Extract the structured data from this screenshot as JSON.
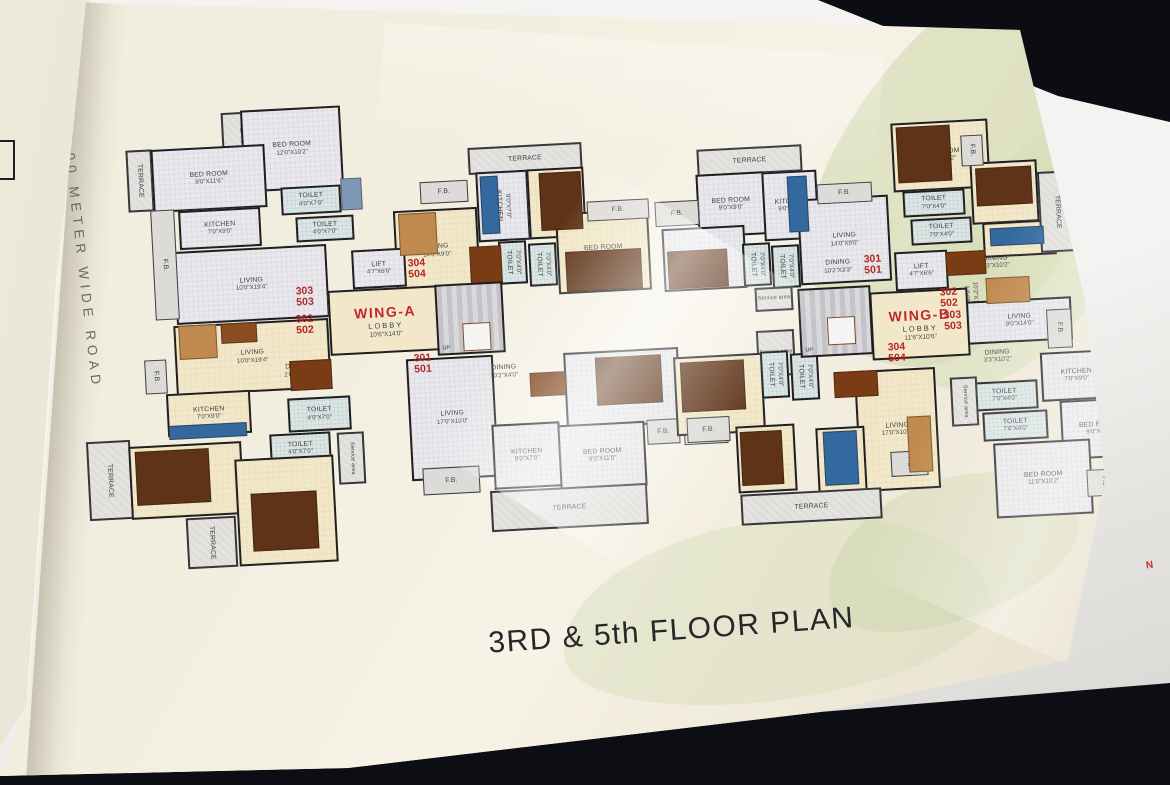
{
  "scene": {
    "title": "3RD & 5th FLOOR PLAN",
    "road_label": "24.00 METER WIDE ROAD",
    "north_marker": "N",
    "colors": {
      "background": "#0d0e14",
      "page": "#f2eedf",
      "wall": "#1f1f22",
      "unit_number": "#b42525",
      "wing_label": "#c02828",
      "room_cream": "#f2e8c9",
      "room_gray": "#e9e9ed",
      "terrace": "#e3e2de",
      "toilet": "#dce6e4",
      "furniture_wood": "#5f3317",
      "kitchen_counter": "#33699e"
    }
  },
  "plan": {
    "cores": [
      {
        "wing": "WING-A",
        "lobby": "LOBBY",
        "dims": "10'6\"X14'0\"",
        "x": 329,
        "y": 288,
        "w": 113,
        "h": 65,
        "stair": {
          "x": 436,
          "y": 283,
          "w": 68,
          "h": 71,
          "lx": 24,
          "ly": 38,
          "lw": 26,
          "lh": 26
        },
        "up": "UP"
      },
      {
        "wing": "WING-B",
        "lobby": "LOBBY",
        "dims": "11'6\"X10'6\"",
        "x": 871,
        "y": 290,
        "w": 98,
        "h": 68,
        "stair": {
          "x": 799,
          "y": 287,
          "w": 73,
          "h": 69,
          "lx": 26,
          "ly": 28,
          "lw": 26,
          "lh": 26
        },
        "up": "UP"
      }
    ],
    "units": [
      {
        "a": "303",
        "b": "503",
        "x": 296,
        "y": 286
      },
      {
        "a": "302",
        "b": "502",
        "x": 296,
        "y": 314
      },
      {
        "a": "304",
        "b": "504",
        "x": 408,
        "y": 258
      },
      {
        "a": "301",
        "b": "501",
        "x": 414,
        "y": 353
      },
      {
        "a": "301",
        "b": "501",
        "x": 864,
        "y": 254
      },
      {
        "a": "302",
        "b": "502",
        "x": 940,
        "y": 287
      },
      {
        "a": "303",
        "b": "503",
        "x": 944,
        "y": 310
      },
      {
        "a": "304",
        "b": "504",
        "x": 888,
        "y": 342
      }
    ],
    "rooms": [
      {
        "label": "TERRACE",
        "x": 222,
        "y": 112,
        "w": 40,
        "h": 56,
        "f": "terrace",
        "v": 1
      },
      {
        "label": "BED ROOM",
        "dims": "12'0\"X10'2\"",
        "x": 242,
        "y": 108,
        "w": 100,
        "h": 82,
        "f": "hatch"
      },
      {
        "label": "TERRACE",
        "x": 127,
        "y": 150,
        "w": 26,
        "h": 62,
        "f": "terrace",
        "v": 1
      },
      {
        "label": "BED ROOM",
        "dims": "9'0\"X11'6\"",
        "x": 152,
        "y": 147,
        "w": 114,
        "h": 63,
        "f": "hatch"
      },
      {
        "label": "TOILET",
        "dims": "4'0\"X7'0\"",
        "x": 281,
        "y": 186,
        "w": 60,
        "h": 28,
        "f": "toilet"
      },
      {
        "label": "TOILET",
        "dims": "4'0\"X7'0\"",
        "x": 296,
        "y": 216,
        "w": 58,
        "h": 25,
        "f": "toilet"
      },
      {
        "label": "KITCHEN",
        "dims": "7'0\"X9'0\"",
        "x": 179,
        "y": 209,
        "w": 82,
        "h": 39,
        "f": "hatch"
      },
      {
        "label": "DINING",
        "dims": "2'0\"X10'2\"",
        "x": 264,
        "y": 241,
        "w": 66,
        "h": 23,
        "f": "hatch",
        "open": 1
      },
      {
        "label": "LIVING",
        "dims": "10'0\"X19'4\"",
        "x": 175,
        "y": 248,
        "w": 153,
        "h": 73,
        "f": "hatch"
      },
      {
        "label": "F.B.",
        "x": 153,
        "y": 210,
        "w": 24,
        "h": 110,
        "f": "fb",
        "v": 1
      },
      {
        "label": "LIVING",
        "dims": "10'0\"X19'4\"",
        "x": 175,
        "y": 322,
        "w": 155,
        "h": 70,
        "f": "cream"
      },
      {
        "label": "DINING",
        "dims": "2'0\"X10'0\"",
        "x": 266,
        "y": 352,
        "w": 64,
        "h": 38,
        "f": "cream",
        "open": 1
      },
      {
        "label": "F.B.",
        "x": 145,
        "y": 360,
        "w": 22,
        "h": 34,
        "f": "fb",
        "v": 1
      },
      {
        "label": "KITCHEN",
        "dims": "7'0\"X9'0\"",
        "x": 167,
        "y": 392,
        "w": 84,
        "h": 43,
        "f": "cream"
      },
      {
        "label": "TOILET",
        "dims": "4'0\"X7'0\"",
        "x": 288,
        "y": 397,
        "w": 63,
        "h": 34,
        "f": "toilet"
      },
      {
        "label": "TOILET",
        "dims": "4'0\"X7'0\"",
        "x": 270,
        "y": 433,
        "w": 61,
        "h": 31,
        "f": "toilet"
      },
      {
        "label": "Service area",
        "x": 338,
        "y": 432,
        "w": 27,
        "h": 52,
        "f": "terrace",
        "v": 1,
        "small": 1
      },
      {
        "label": "TERRACE",
        "x": 88,
        "y": 441,
        "w": 44,
        "h": 79,
        "f": "terrace",
        "v": 1
      },
      {
        "label": "BED ROOM",
        "dims": "9'0\"X11'6\"",
        "x": 130,
        "y": 444,
        "w": 113,
        "h": 73,
        "f": "cream"
      },
      {
        "label": "TERRACE",
        "x": 187,
        "y": 517,
        "w": 50,
        "h": 51,
        "f": "terrace",
        "v": 1
      },
      {
        "label": "BED ROOM",
        "dims": "12'0\"X10'2\"",
        "x": 237,
        "y": 457,
        "w": 99,
        "h": 107,
        "f": "cream"
      },
      {
        "label": "TERRACE",
        "x": 468,
        "y": 145,
        "w": 114,
        "h": 27,
        "f": "terrace"
      },
      {
        "label": "KITCHEN",
        "dims": "9'0\"X7'0\"",
        "x": 477,
        "y": 171,
        "w": 52,
        "h": 70,
        "f": "hatch",
        "v": 1
      },
      {
        "label": "BED ROOM",
        "dims": "9'0\"X9'0\"",
        "x": 528,
        "y": 168,
        "w": 57,
        "h": 70,
        "f": "cream",
        "v": 1
      },
      {
        "label": "F.B.",
        "x": 420,
        "y": 181,
        "w": 48,
        "h": 22,
        "f": "fb"
      },
      {
        "label": "DINING",
        "dims": "12'7\"X3'3\"",
        "x": 447,
        "y": 207,
        "w": 32,
        "h": 85,
        "f": "cream",
        "v": 1,
        "open": 1
      },
      {
        "label": "LIVING",
        "dims": "14'0\"X9'0\"",
        "x": 395,
        "y": 209,
        "w": 84,
        "h": 84,
        "f": "cream"
      },
      {
        "label": "TOILET",
        "dims": "7'0\"X4'0\"",
        "x": 499,
        "y": 241,
        "w": 28,
        "h": 43,
        "f": "toilet",
        "v": 1
      },
      {
        "label": "TOILET",
        "dims": "7'0\"X4'0\"",
        "x": 529,
        "y": 243,
        "w": 28,
        "h": 43,
        "f": "toilet",
        "v": 1
      },
      {
        "label": "BED ROOM",
        "dims": "10'2\"X11'0\"",
        "x": 557,
        "y": 211,
        "w": 93,
        "h": 81,
        "f": "cream"
      },
      {
        "label": "F.B.",
        "x": 587,
        "y": 200,
        "w": 62,
        "h": 20,
        "f": "fb"
      },
      {
        "label": "LIFT",
        "dims": "4'7\"X6'6\"",
        "x": 352,
        "y": 249,
        "w": 54,
        "h": 39,
        "f": "hatch"
      },
      {
        "label": "LIVING",
        "dims": "17'0\"X10'0\"",
        "x": 409,
        "y": 357,
        "w": 87,
        "h": 122,
        "f": "hatch"
      },
      {
        "label": "DINING",
        "dims": "10'2\"X4'0\"",
        "x": 468,
        "y": 352,
        "w": 72,
        "h": 40,
        "f": "hatch",
        "open": 1
      },
      {
        "label": "BED ROOM",
        "dims": "10'2\"X12'0\"",
        "x": 565,
        "y": 350,
        "w": 115,
        "h": 76,
        "f": "hatch"
      },
      {
        "label": "KITCHEN",
        "dims": "9'0\"X7'0\"",
        "x": 493,
        "y": 423,
        "w": 68,
        "h": 65,
        "f": "hatch"
      },
      {
        "label": "BED ROOM",
        "dims": "9'0\"X11'0\"",
        "x": 559,
        "y": 423,
        "w": 87,
        "h": 65,
        "f": "hatch"
      },
      {
        "label": "TERRACE",
        "x": 491,
        "y": 487,
        "w": 157,
        "h": 41,
        "f": "terrace"
      },
      {
        "label": "F.B.",
        "x": 423,
        "y": 467,
        "w": 57,
        "h": 27,
        "f": "fb"
      },
      {
        "label": "F.B.",
        "x": 647,
        "y": 419,
        "w": 33,
        "h": 25,
        "f": "fb"
      },
      {
        "label": "F.B.",
        "x": 684,
        "y": 419,
        "w": 44,
        "h": 25,
        "f": "fb"
      },
      {
        "label": "TERRACE",
        "x": 697,
        "y": 147,
        "w": 105,
        "h": 27,
        "f": "terrace"
      },
      {
        "label": "BED ROOM",
        "dims": "9'0\"X9'0\"",
        "x": 697,
        "y": 173,
        "w": 68,
        "h": 63,
        "f": "hatch"
      },
      {
        "label": "KITCHEN",
        "dims": "9'0\"X7'0\"",
        "x": 763,
        "y": 171,
        "w": 55,
        "h": 69,
        "f": "hatch"
      },
      {
        "label": "F.B.",
        "x": 655,
        "y": 201,
        "w": 44,
        "h": 25,
        "f": "fb"
      },
      {
        "label": "BED ROOM",
        "dims": "10'2\"X11'0\"",
        "x": 663,
        "y": 227,
        "w": 83,
        "h": 63,
        "f": "hatch"
      },
      {
        "label": "TOILET",
        "dims": "7'0\"X4'0\"",
        "x": 743,
        "y": 243,
        "w": 28,
        "h": 43,
        "f": "toilet",
        "v": 1
      },
      {
        "label": "TOILET",
        "dims": "7'0\"X4'0\"",
        "x": 772,
        "y": 245,
        "w": 28,
        "h": 43,
        "f": "toilet",
        "v": 1
      },
      {
        "label": "LIVING",
        "dims": "14'0\"X9'0\"",
        "x": 799,
        "y": 197,
        "w": 91,
        "h": 86,
        "f": "hatch"
      },
      {
        "label": "DINING",
        "dims": "10'2\"X3'3\"",
        "x": 800,
        "y": 251,
        "w": 76,
        "h": 32,
        "f": "hatch",
        "open": 1
      },
      {
        "label": "F.B.",
        "x": 817,
        "y": 183,
        "w": 55,
        "h": 20,
        "f": "fb"
      },
      {
        "label": "Service area",
        "x": 755,
        "y": 287,
        "w": 38,
        "h": 24,
        "f": "terrace",
        "small": 1
      },
      {
        "label": "Service area",
        "x": 757,
        "y": 330,
        "w": 38,
        "h": 46,
        "f": "terrace",
        "small": 1
      },
      {
        "label": "LIFT",
        "dims": "4'7\"X6'6\"",
        "x": 895,
        "y": 251,
        "w": 53,
        "h": 39,
        "f": "hatch"
      },
      {
        "label": "BED ROOM",
        "dims": "11'6\"X10'2\"",
        "x": 892,
        "y": 121,
        "w": 97,
        "h": 69,
        "f": "cream"
      },
      {
        "label": "TOILET",
        "dims": "7'0\"X4'0\"",
        "x": 903,
        "y": 190,
        "w": 62,
        "h": 26,
        "f": "toilet"
      },
      {
        "label": "TOILET",
        "dims": "7'0\"X4'0\"",
        "x": 911,
        "y": 218,
        "w": 61,
        "h": 26,
        "f": "toilet"
      },
      {
        "label": "BED ROOM",
        "dims": "9'0\"X9'0\"",
        "x": 971,
        "y": 161,
        "w": 67,
        "h": 62,
        "f": "cream"
      },
      {
        "label": "KITCHEN",
        "dims": "7'0\"X9'0\"",
        "x": 983,
        "y": 221,
        "w": 73,
        "h": 35,
        "f": "cream"
      },
      {
        "label": "DINING",
        "dims": "3'3\"X10'2\"",
        "x": 957,
        "y": 247,
        "w": 77,
        "h": 31,
        "f": "cream",
        "open": 1
      },
      {
        "label": "LIVING",
        "dims": "10'2\"X14'0\"",
        "x": 944,
        "y": 257,
        "w": 53,
        "h": 81,
        "f": "cream",
        "v": 1,
        "open": 1
      },
      {
        "label": "TERRACE",
        "x": 1039,
        "y": 171,
        "w": 37,
        "h": 81,
        "f": "terrace",
        "v": 1
      },
      {
        "label": "F.B.",
        "x": 961,
        "y": 135,
        "w": 22,
        "h": 31,
        "f": "fb",
        "v": 1
      },
      {
        "label": "LIVING",
        "dims": "9'0\"X14'0\"",
        "x": 967,
        "y": 299,
        "w": 105,
        "h": 43,
        "f": "hatch"
      },
      {
        "label": "DINING",
        "dims": "3'3\"X10'2\"",
        "x": 961,
        "y": 339,
        "w": 73,
        "h": 35,
        "f": "hatch",
        "open": 1
      },
      {
        "label": "F.B.",
        "x": 1047,
        "y": 309,
        "w": 25,
        "h": 39,
        "f": "fb",
        "v": 1
      },
      {
        "label": "TOILET",
        "dims": "7'0\"X4'0\"",
        "x": 971,
        "y": 381,
        "w": 67,
        "h": 29,
        "f": "toilet"
      },
      {
        "label": "TOILET",
        "dims": "7'0\"X4'0\"",
        "x": 983,
        "y": 411,
        "w": 65,
        "h": 29,
        "f": "toilet"
      },
      {
        "label": "KITCHEN",
        "dims": "7'0\"X9'0\"",
        "x": 1041,
        "y": 351,
        "w": 71,
        "h": 49,
        "f": "hatch"
      },
      {
        "label": "BED ROOM",
        "dims": "9'0\"X9'0\"",
        "x": 1061,
        "y": 399,
        "w": 75,
        "h": 59,
        "f": "hatch"
      },
      {
        "label": "BED ROOM",
        "dims": "11'0\"X10'2\"",
        "x": 995,
        "y": 441,
        "w": 97,
        "h": 75,
        "f": "hatch"
      },
      {
        "label": "TERRACE",
        "x": 1115,
        "y": 357,
        "w": 39,
        "h": 87,
        "f": "terrace",
        "v": 1
      },
      {
        "label": "Service area",
        "x": 951,
        "y": 377,
        "w": 27,
        "h": 49,
        "f": "terrace",
        "v": 1,
        "small": 1
      },
      {
        "label": "F.B.",
        "x": 1087,
        "y": 469,
        "w": 35,
        "h": 27,
        "f": "fb",
        "v": 1
      },
      {
        "label": "BED ROOM",
        "dims": "10'2\"X12'0\"",
        "x": 675,
        "y": 355,
        "w": 89,
        "h": 79,
        "f": "cream"
      },
      {
        "label": "TOILET",
        "dims": "7'0\"X4'0\"",
        "x": 761,
        "y": 351,
        "w": 28,
        "h": 47,
        "f": "toilet",
        "v": 1
      },
      {
        "label": "TOILET",
        "dims": "7'0\"X4'0\"",
        "x": 791,
        "y": 353,
        "w": 28,
        "h": 47,
        "f": "toilet",
        "v": 1
      },
      {
        "label": "DINING",
        "dims": "10'2\"X4'0\"",
        "x": 825,
        "y": 367,
        "w": 63,
        "h": 35,
        "f": "cream",
        "open": 1
      },
      {
        "label": "LIVING",
        "dims": "17'0\"X10'0\"",
        "x": 857,
        "y": 369,
        "w": 81,
        "h": 121,
        "f": "cream"
      },
      {
        "label": "BED ROOM",
        "dims": "9'0\"X11'0\"",
        "x": 737,
        "y": 425,
        "w": 59,
        "h": 67,
        "f": "cream",
        "v": 1
      },
      {
        "label": "KITCHEN",
        "dims": "9'0\"X7'0\"",
        "x": 817,
        "y": 427,
        "w": 49,
        "h": 67,
        "f": "cream",
        "v": 1
      },
      {
        "label": "TERRACE",
        "x": 741,
        "y": 491,
        "w": 141,
        "h": 31,
        "f": "terrace"
      },
      {
        "label": "F.B.",
        "x": 687,
        "y": 417,
        "w": 43,
        "h": 25,
        "f": "fb"
      },
      {
        "label": "F.B.",
        "x": 891,
        "y": 451,
        "w": 37,
        "h": 25,
        "f": "fb",
        "v": 1
      }
    ],
    "furniture": [
      {
        "x": 341,
        "y": 178,
        "w": 21,
        "h": 32,
        "c": "#7d98b5"
      },
      {
        "x": 179,
        "y": 325,
        "w": 38,
        "h": 34,
        "c": "#c08a4e"
      },
      {
        "x": 221,
        "y": 323,
        "w": 36,
        "h": 20,
        "c": "#8a4d22"
      },
      {
        "x": 290,
        "y": 360,
        "w": 42,
        "h": 30,
        "c": "#7a3c14"
      },
      {
        "x": 169,
        "y": 424,
        "w": 78,
        "h": 14,
        "c": "#33699e"
      },
      {
        "x": 136,
        "y": 450,
        "w": 74,
        "h": 54,
        "c": "#5f3317"
      },
      {
        "x": 252,
        "y": 492,
        "w": 66,
        "h": 58,
        "c": "#5f3317"
      },
      {
        "x": 399,
        "y": 213,
        "w": 38,
        "h": 42,
        "c": "#c08a4e"
      },
      {
        "x": 481,
        "y": 176,
        "w": 18,
        "h": 58,
        "c": "#33699e"
      },
      {
        "x": 540,
        "y": 172,
        "w": 42,
        "h": 58,
        "c": "#5f3317"
      },
      {
        "x": 566,
        "y": 250,
        "w": 76,
        "h": 40,
        "c": "#5f3317"
      },
      {
        "x": 470,
        "y": 246,
        "w": 32,
        "h": 38,
        "c": "#7a3c14"
      },
      {
        "x": 596,
        "y": 356,
        "w": 66,
        "h": 48,
        "c": "#5f3317"
      },
      {
        "x": 530,
        "y": 372,
        "w": 36,
        "h": 24,
        "c": "#7a3c14"
      },
      {
        "x": 788,
        "y": 176,
        "w": 20,
        "h": 56,
        "c": "#33699e"
      },
      {
        "x": 668,
        "y": 250,
        "w": 60,
        "h": 38,
        "c": "#5f3317"
      },
      {
        "x": 897,
        "y": 126,
        "w": 54,
        "h": 56,
        "c": "#5f3317"
      },
      {
        "x": 976,
        "y": 167,
        "w": 56,
        "h": 38,
        "c": "#5f3317"
      },
      {
        "x": 990,
        "y": 227,
        "w": 54,
        "h": 18,
        "c": "#33699e"
      },
      {
        "x": 946,
        "y": 251,
        "w": 40,
        "h": 24,
        "c": "#7a3c14"
      },
      {
        "x": 986,
        "y": 277,
        "w": 44,
        "h": 26,
        "c": "#c08a4e"
      },
      {
        "x": 681,
        "y": 361,
        "w": 64,
        "h": 50,
        "c": "#5f3317"
      },
      {
        "x": 741,
        "y": 431,
        "w": 42,
        "h": 54,
        "c": "#5f3317"
      },
      {
        "x": 824,
        "y": 431,
        "w": 34,
        "h": 54,
        "c": "#33699e"
      },
      {
        "x": 834,
        "y": 371,
        "w": 44,
        "h": 26,
        "c": "#7a3c14"
      },
      {
        "x": 908,
        "y": 416,
        "w": 24,
        "h": 56,
        "c": "#c08a4e"
      }
    ]
  }
}
